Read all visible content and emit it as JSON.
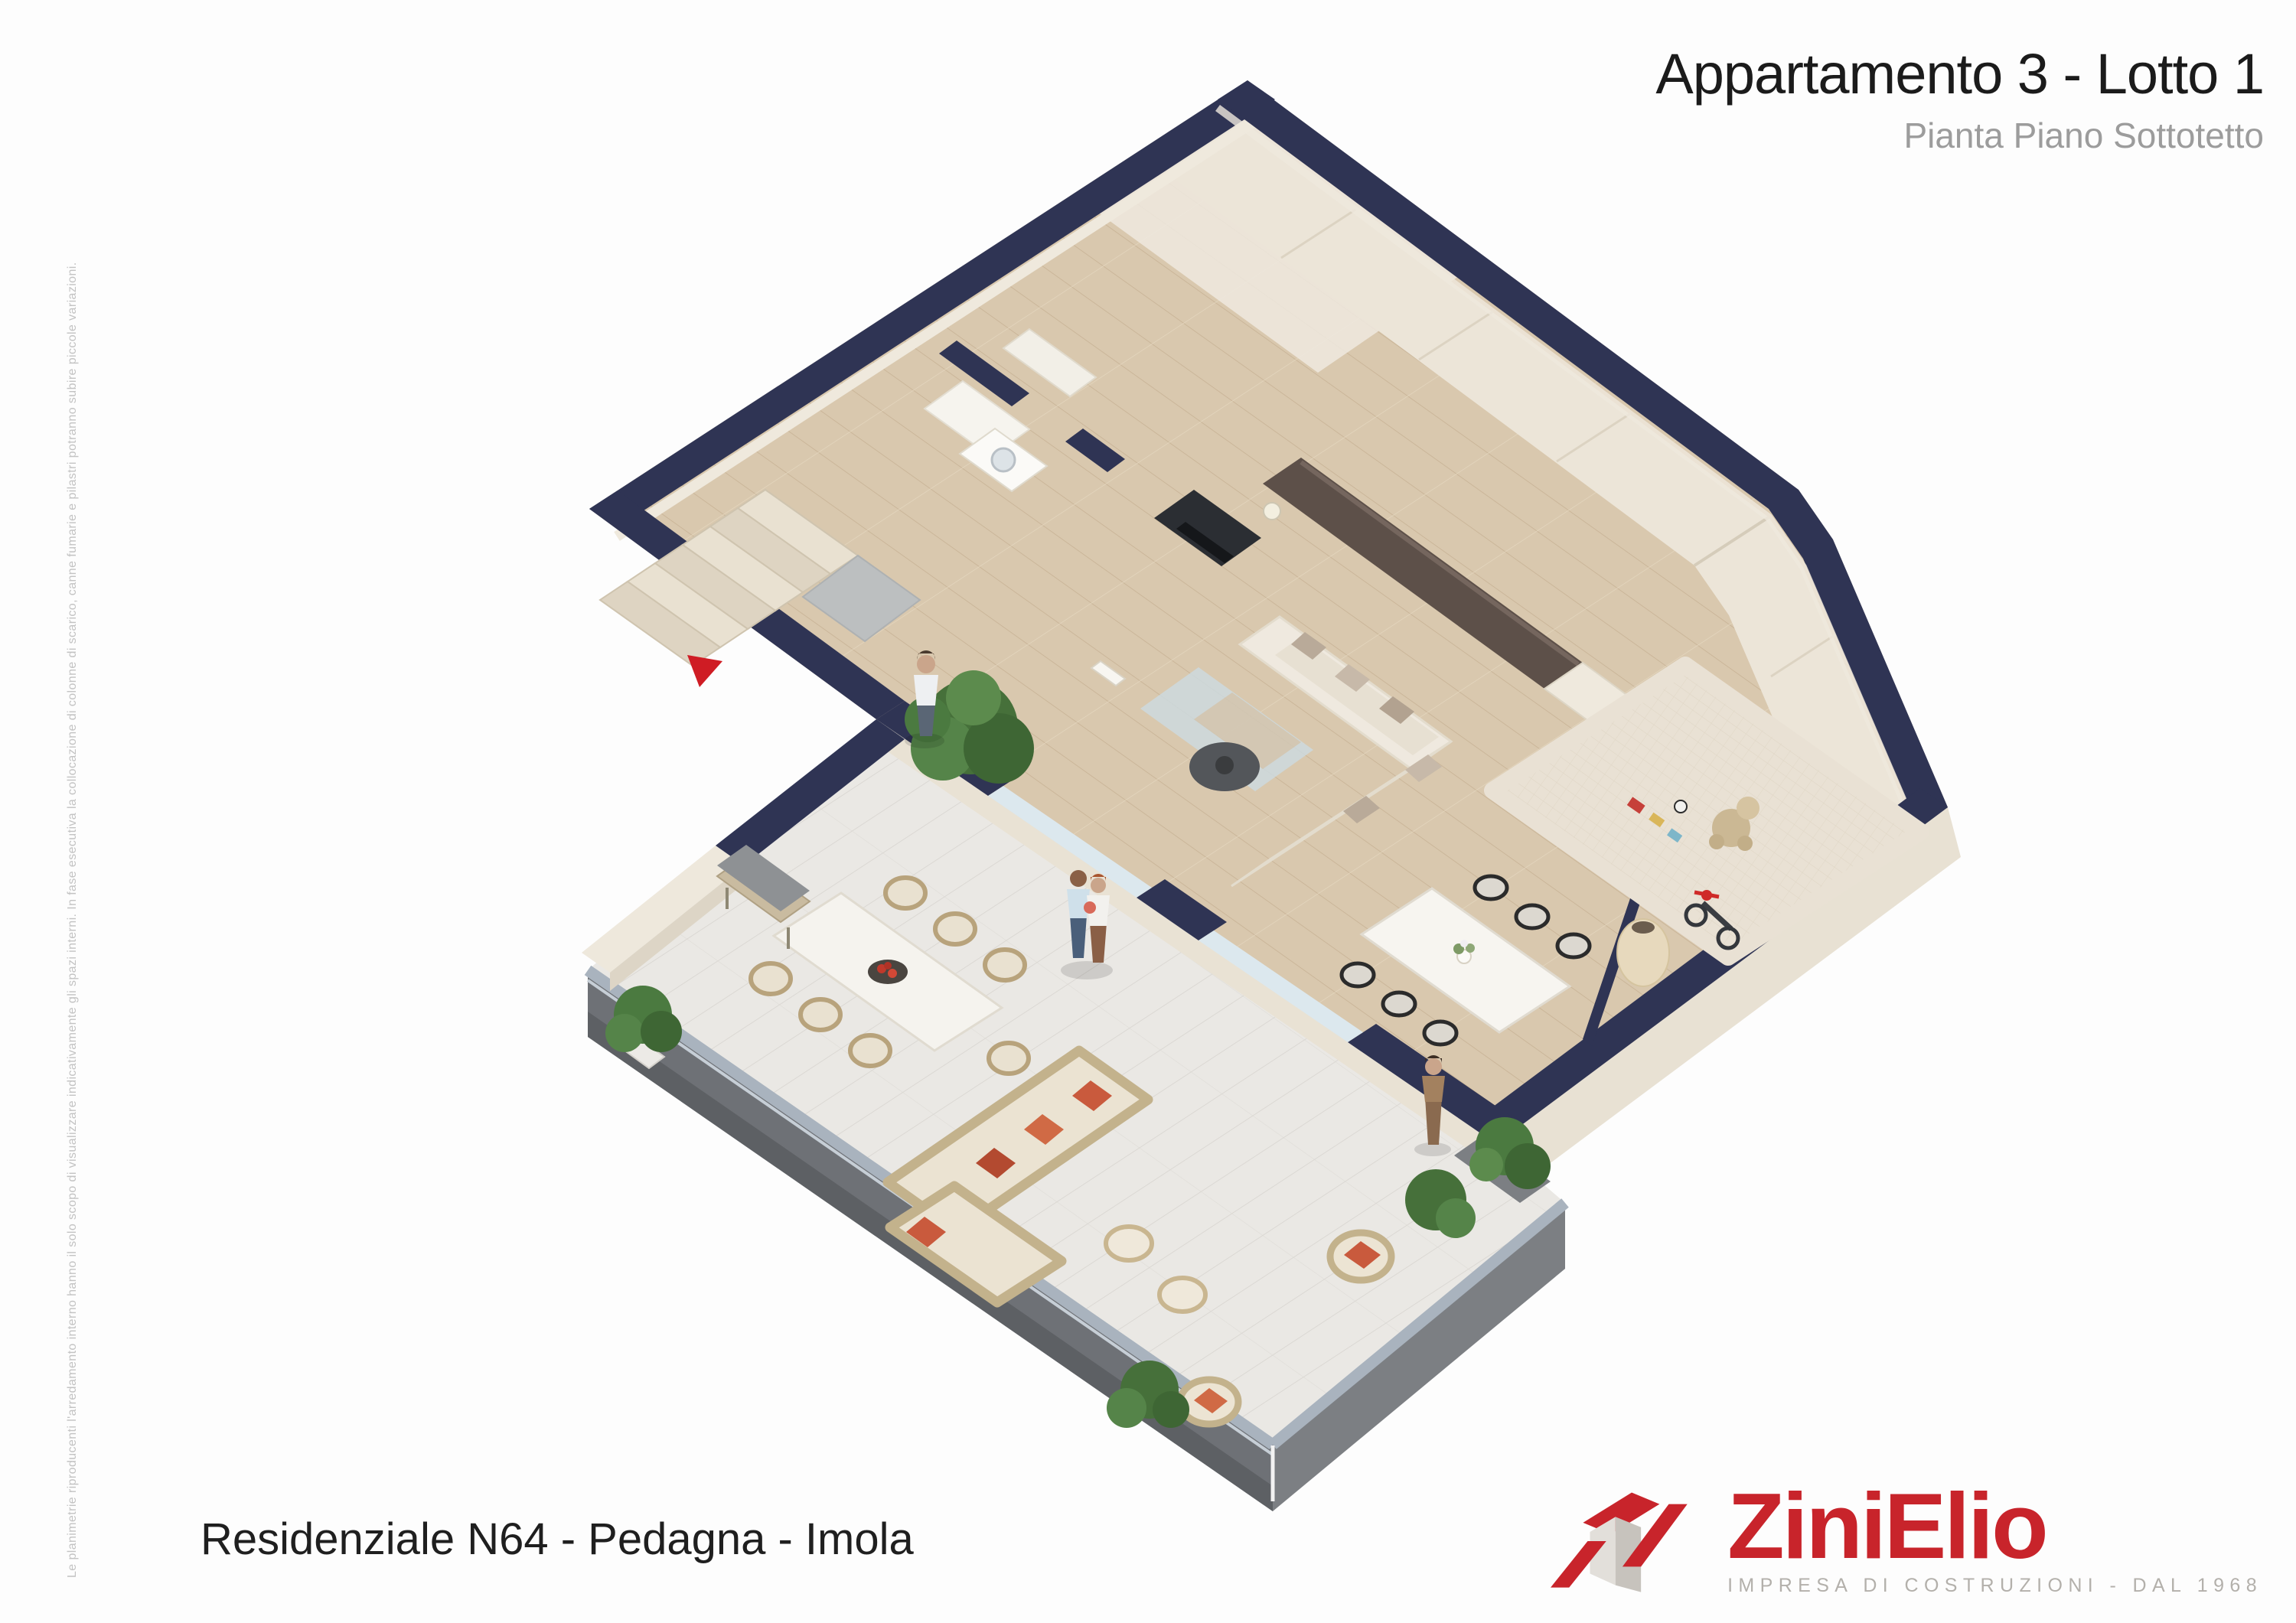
{
  "header": {
    "title": "Appartamento 3 - Lotto 1",
    "subtitle": "Pianta Piano Sottotetto"
  },
  "footer": {
    "project": "Residenziale N64 - Pedagna - Imola"
  },
  "logo": {
    "name": "ZiniElio",
    "tagline": "IMPRESA DI COSTRUZIONI - DAL 1968",
    "brand_red": "#c8242b",
    "tagline_gray": "#b3b0ab"
  },
  "disclaimer": {
    "text": "Le planimetrie riproducenti l'arredamento interno hanno il solo scopo di visualizzare indicativamente gli spazi interni. In fase esecutiva la collocazione di colonne di scarico, canne fumarie e pilastri potranno subire piccole variazioni."
  },
  "floor_plan": {
    "wall_color": "#2f3454",
    "wood_floor_color": "#d9c8ae",
    "terrace_tile_color": "#eae8e4",
    "knee_wall_color": "#ece5d8",
    "railing_color": "#6e7176",
    "accent_pillow_color": "#c95a3d",
    "entrance_marker_color": "#cf1c24"
  }
}
